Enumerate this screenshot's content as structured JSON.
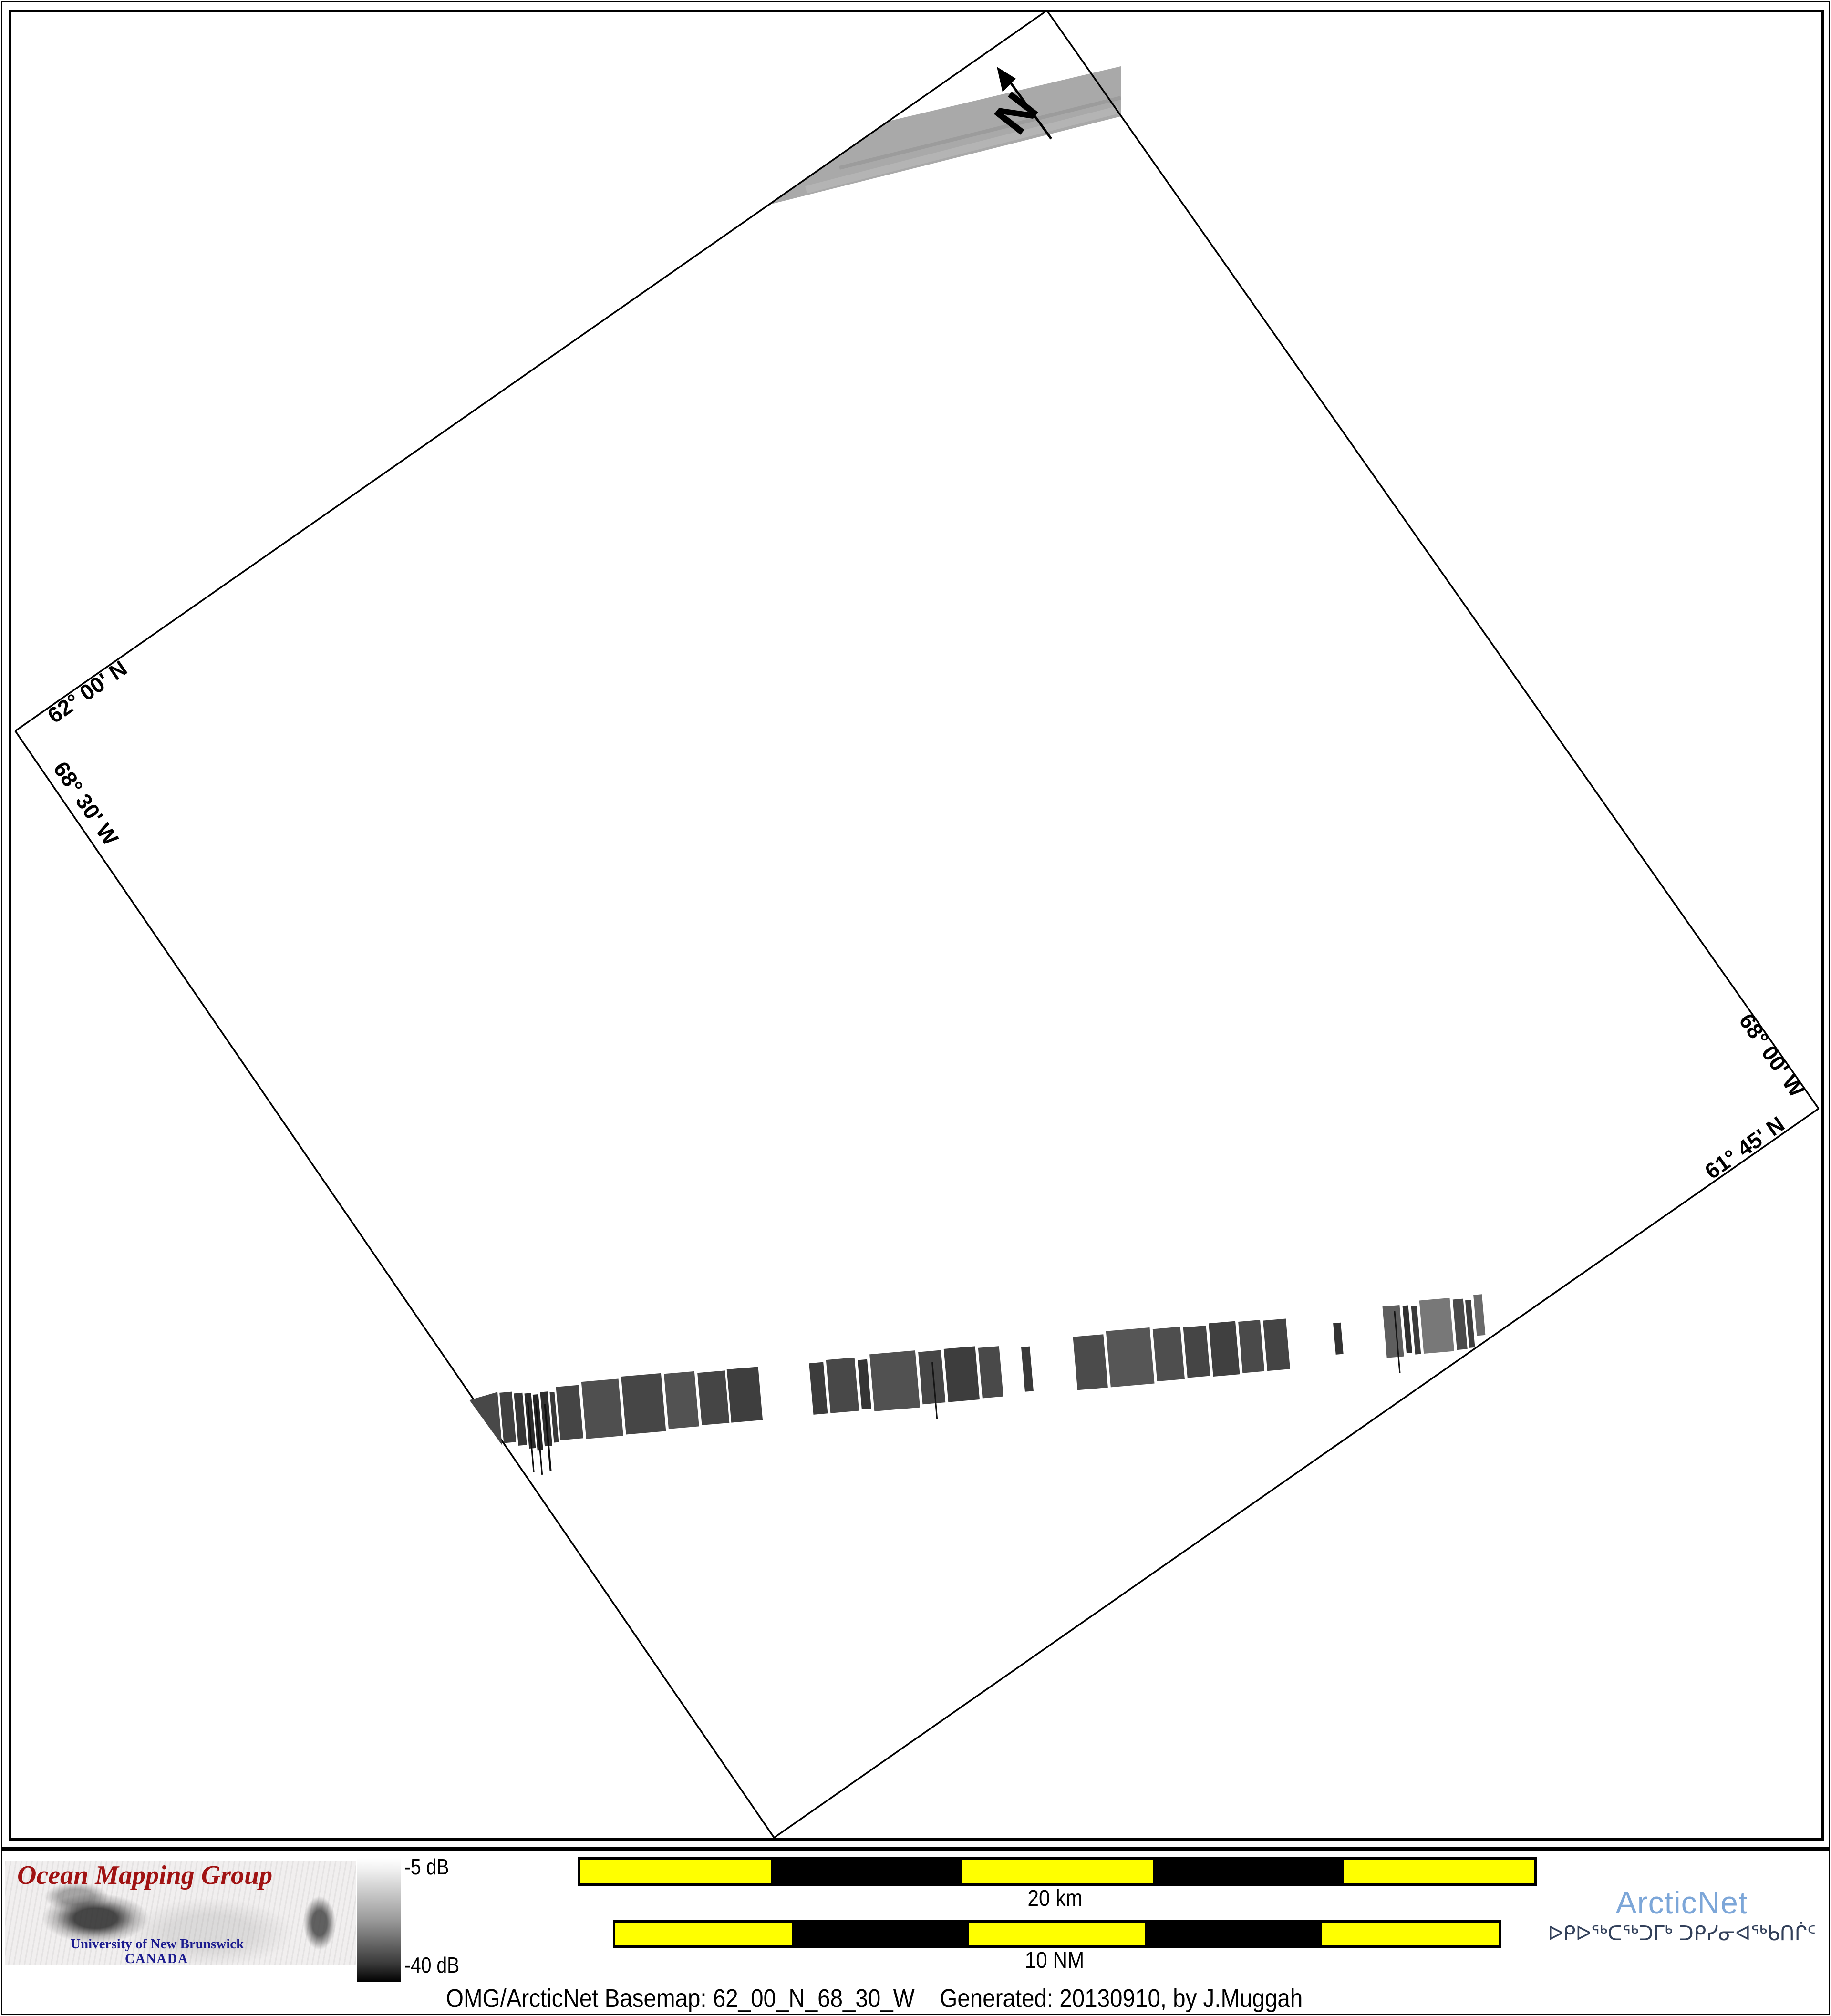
{
  "map": {
    "graticule_labels": {
      "top_left_lat": "62° 00' N",
      "bottom_left_lon": "68° 30' W",
      "top_right_lon": "68° 00' W",
      "bottom_right_lat": "61° 45' N"
    },
    "north_label": "N"
  },
  "footer": {
    "omg": {
      "title": "Ocean Mapping Group",
      "university": "University of New Brunswick",
      "country": "CANADA"
    },
    "colorbar": {
      "max_label": "-5 dB",
      "min_label": "-40 dB",
      "top_color": "#ffffff",
      "bottom_color": "#000000"
    },
    "scale_km": {
      "label": "20 km"
    },
    "scale_nm": {
      "label": "10 NM"
    },
    "arcticnet": {
      "name": "ArcticNet",
      "tagline": "ᐅᑭᐅᖅᑕᖅᑐᒥᒃ ᑐᑭᓯᓂᐊᖅᑲᑎᒌᑦ",
      "brand_color": "#7ca6d8",
      "tagline_color": "#32405a"
    },
    "caption": "OMG/ArcticNet Basemap: 62_00_N_68_30_W    Generated: 20130910, by J.Muggah"
  },
  "colors": {
    "scalebar_yellow": "#ffff00",
    "scalebar_black": "#000000",
    "omg_red": "#a01313",
    "unb_navy": "#1c1c8f",
    "swath_gray": "#a9a9a9",
    "border_black": "#000000"
  }
}
